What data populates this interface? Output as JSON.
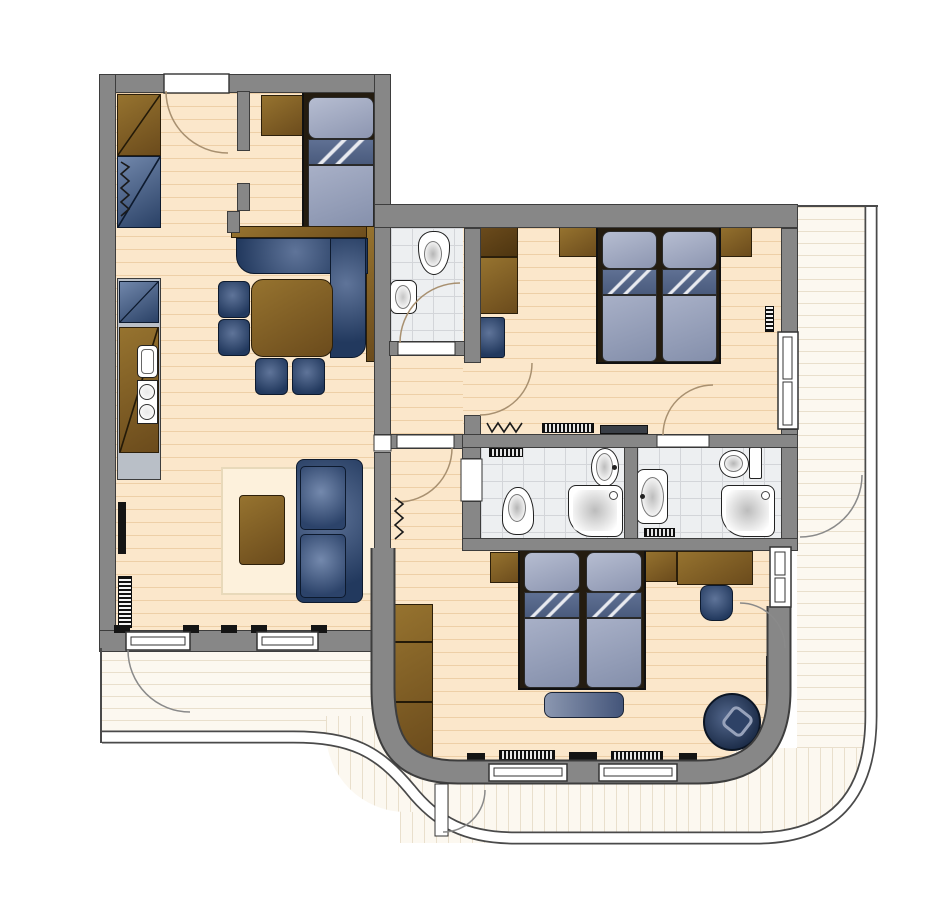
{
  "plan": {
    "label": "Apartment floor plan",
    "width_px": 940,
    "height_px": 897,
    "style": "2D architectural top-view, no text labels"
  },
  "colors": {
    "wall_fill": "#878787",
    "wall_outline": "#3d3d3d",
    "wood_floor": "#fbe7cb",
    "wood_floor_stripe": "#e6c294",
    "bathroom_tile": "#edeff1",
    "terrace_deck": "#fcf8f0",
    "terrace_stripe": "#e9dfcc",
    "furniture_brown": "#7a5a26",
    "furniture_navy": "#24395e",
    "mattress_blue": "#98a2bd",
    "fixture_white": "#ffffff",
    "door_arc": "#a89070"
  },
  "rooms": {
    "living": {
      "label": "Living / dining / kitchen"
    },
    "small_bedroom": {
      "label": "Single bedroom"
    },
    "wc": {
      "label": "Guest WC"
    },
    "hall_upper": {
      "label": "Hall"
    },
    "hall_lower": {
      "label": "Hall"
    },
    "bedroom_top": {
      "label": "Double bedroom"
    },
    "bathroom_left": {
      "label": "Shower bathroom"
    },
    "bathroom_right": {
      "label": "En-suite shower bathroom"
    },
    "bedroom_bottom": {
      "label": "Double bedroom"
    },
    "terrace_left": {
      "label": "Terrace"
    },
    "terrace_right": {
      "label": "Terrace"
    },
    "terrace_bottom": {
      "label": "Terrace"
    }
  },
  "furniture_inventory": [
    "entry wardrobe",
    "coat rack",
    "single bed",
    "bedside shelf",
    "corner dining bench",
    "dining table",
    "4 dining chairs",
    "kitchenette with sink and hob",
    "refrigerator",
    "tv",
    "radiators",
    "rug",
    "coffee table",
    "two-seat sofa",
    "double bed (top bedroom)",
    "wardrobes",
    "night stool",
    "wc toilet and basin",
    "2 showers",
    "2 basins",
    "2 toilets",
    "double bed (bottom bedroom)",
    "foot bench",
    "desk",
    "stool",
    "swivel armchair",
    "built-in wardrobe (curved)"
  ]
}
